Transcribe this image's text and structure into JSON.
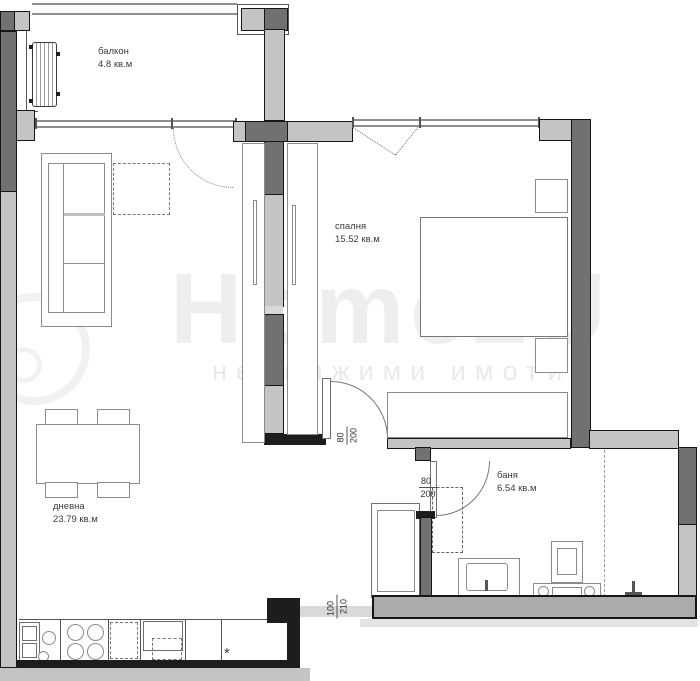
{
  "floorplan": {
    "rooms": [
      {
        "id": "balcony",
        "name": "балкон",
        "area": "4.8 кв.м"
      },
      {
        "id": "bedroom",
        "name": "спалня",
        "area": "15.52 кв.м"
      },
      {
        "id": "living",
        "name": "дневна",
        "area": "23.79 кв.м"
      },
      {
        "id": "bathroom",
        "name": "баня",
        "area": "6.54 кв.м"
      }
    ],
    "dimensions": [
      {
        "id": "bedroom-door",
        "w": "80",
        "h": "200",
        "orientation": "vertical"
      },
      {
        "id": "bathroom-door",
        "w": "80",
        "h": "200",
        "orientation": "horizontal"
      },
      {
        "id": "kitchen-passage",
        "w": "100",
        "h": "210",
        "orientation": "vertical"
      }
    ],
    "symbols": {
      "tap": "*"
    },
    "watermark": {
      "logo": "Home2U",
      "subtitle": "недвижими имоти"
    },
    "colors": {
      "wall_dark": "#717171",
      "wall_light": "#c4c4c4",
      "outline": "#161616",
      "furniture_line": "#8b8b8b",
      "label_text": "#3b3b3b",
      "watermark": "rgba(0,0,0,0.07)"
    }
  }
}
